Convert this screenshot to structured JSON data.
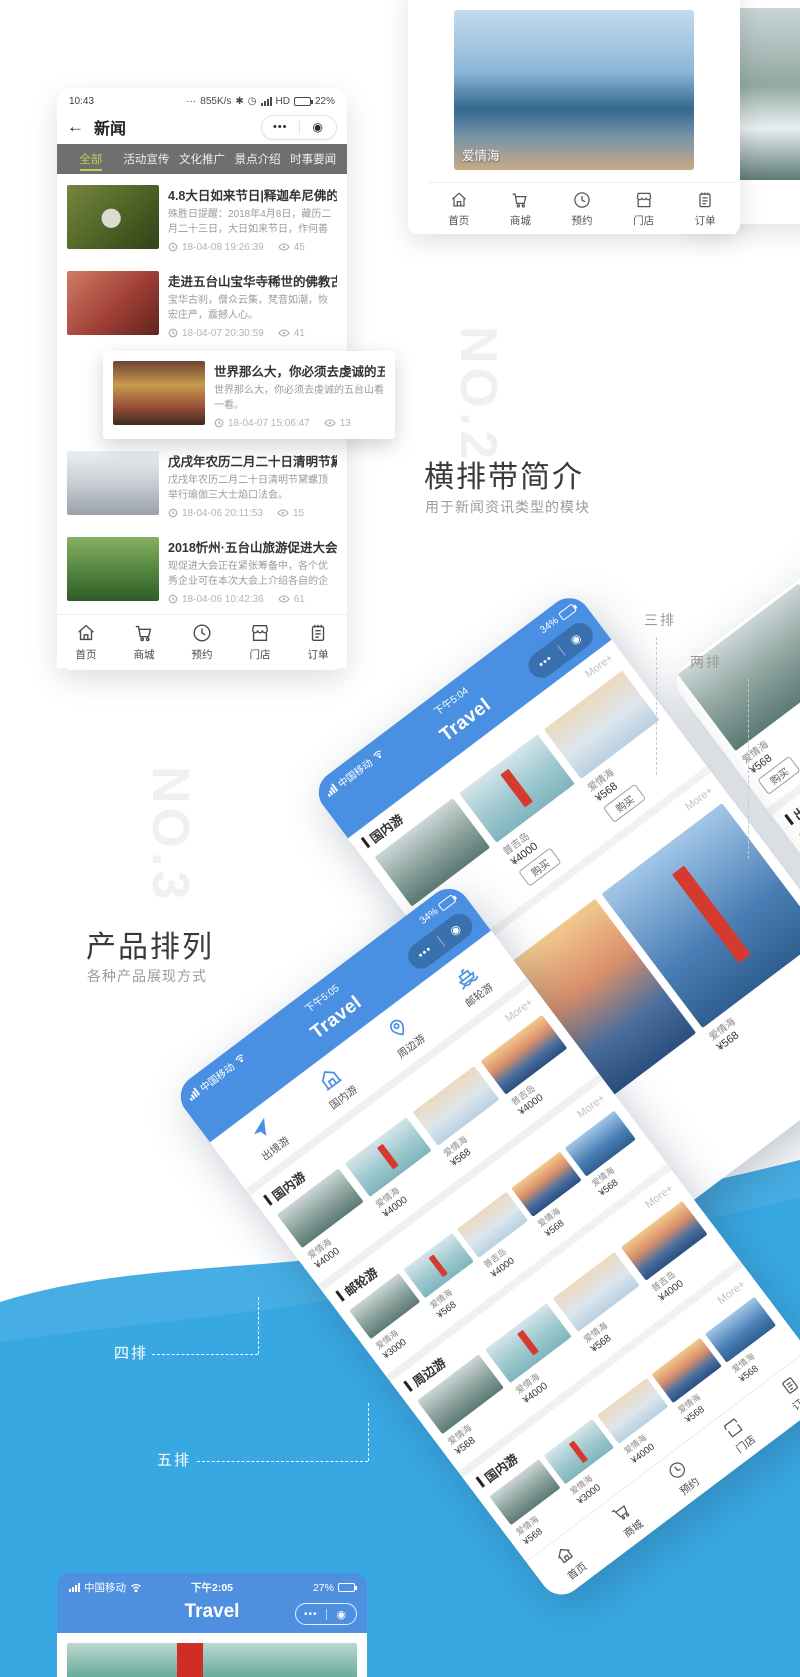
{
  "watermarks": {
    "no2": "NO.2",
    "no3": "NO.3"
  },
  "intro2": {
    "title": "横排带简介",
    "subtitle": "用于新闻资讯类型的模块"
  },
  "intro3": {
    "title": "产品排列",
    "subtitle": "各种产品展现方式"
  },
  "callouts": {
    "three": "三排",
    "two": "两排",
    "four": "四排",
    "five": "五排"
  },
  "tabbar": [
    "首页",
    "商城",
    "预约",
    "门店",
    "订单"
  ],
  "news_phone": {
    "status": {
      "time": "10:43",
      "dots": "···",
      "net": "855K/s",
      "bt": "✱",
      "alarm": "◷",
      "hd": "HD",
      "battery": "22%"
    },
    "navbar": {
      "back": "←",
      "title": "新闻",
      "menu": "•••",
      "capsule_target": "◉"
    },
    "tabs": [
      "全部",
      "活动宣传",
      "文化推广",
      "景点介绍",
      "时事要闻"
    ],
    "items": [
      {
        "title": "4.8大日如来节日|释迦牟尼佛的清净报",
        "desc": "殊胜日提醒：2018年4月8日，藏历二月二十三日，大日如来节日，作何善恶成亿倍!",
        "time": "18-04-08 19:26:39",
        "views": "45"
      },
      {
        "title": "走进五台山宝华寺稀世的佛教古建筑",
        "desc": "宝华古刹，僧众云集，梵音如潮，恢宏庄严，震撼人心。",
        "time": "18-04-07 20:30:59",
        "views": "41"
      },
      {
        "title": "世界那么大，你必须去虔诚的五台山看",
        "desc": "世界那么大，你必须去虔诚的五台山看一看。",
        "time": "18-04-07 15:06:47",
        "views": "13"
      },
      {
        "title": "戊戌年农历二月二十日清明节黛螺顶举",
        "desc": "戊戌年农历二月二十日清明节黛螺顶举行瑜伽三大士焰口法会。",
        "time": "18-04-06 20:11:53",
        "views": "15"
      },
      {
        "title": "2018忻州·五台山旅游促进大会即将召",
        "desc": "现促进大会正在紧张筹备中，各个优秀企业可在本次大会上介绍各自的企业文化等，大",
        "time": "18-04-06 10:42:36",
        "views": "61"
      }
    ]
  },
  "gallery_phone": {
    "card1_label": "爱情海",
    "card2_label": "爱情海"
  },
  "phone_a": {
    "carrier": "中国移动",
    "time": "下午5:04",
    "battery": "34%",
    "title": "Travel",
    "menu": "•••",
    "capsule_target": "◉",
    "section1": {
      "title": "国内游",
      "more": "More+",
      "items": [
        {
          "name": "爱情海",
          "price": "¥568",
          "buy": "购买"
        },
        {
          "name": "普吉岛",
          "price": "¥4000",
          "buy": "购买"
        },
        {
          "name": "爱情海",
          "price": "¥568",
          "buy": "购买"
        }
      ]
    },
    "section2": {
      "title": "出境游",
      "more": "More+",
      "items": [
        {
          "name": "爱情海",
          "price": "¥4000"
        },
        {
          "name": "爱情海",
          "price": "¥568"
        }
      ]
    }
  },
  "phone_b": {
    "row": {
      "items": [
        {
          "name": "爱情海",
          "price": "¥568",
          "buy": "购买"
        },
        {
          "name": "爱情海",
          "price": "¥4000",
          "buy": "购买"
        }
      ]
    },
    "section": {
      "title": "出境游",
      "more": "More+",
      "items": [
        {
          "name": "爱情海",
          "price": "¥4000"
        }
      ]
    }
  },
  "phone_c": {
    "carrier": "中国移动",
    "time": "下午5:05",
    "battery": "34%",
    "title": "Travel",
    "menu": "•••",
    "capsule_target": "◉",
    "categories": [
      "出境游",
      "国内游",
      "周边游",
      "邮轮游"
    ],
    "section1": {
      "title": "国内游",
      "more": "More+",
      "items": [
        {
          "name": "爱情海",
          "price": "¥4000"
        },
        {
          "name": "爱情海",
          "price": "¥4000"
        },
        {
          "name": "爱情海",
          "price": "¥568"
        },
        {
          "name": "普吉岛",
          "price": "¥4000"
        }
      ]
    },
    "section2": {
      "title": "邮轮游",
      "more": "More+",
      "items": [
        {
          "name": "爱情海",
          "price": "¥3000"
        },
        {
          "name": "爱情海",
          "price": "¥568"
        },
        {
          "name": "普吉岛",
          "price": "¥4000"
        },
        {
          "name": "爱情海",
          "price": "¥568"
        },
        {
          "name": "爱情海",
          "price": "¥568"
        }
      ]
    },
    "section3": {
      "title": "周边游",
      "more": "More+",
      "items": [
        {
          "name": "爱情海",
          "price": "¥568"
        },
        {
          "name": "爱情海",
          "price": "¥4000"
        },
        {
          "name": "爱情海",
          "price": "¥568"
        },
        {
          "name": "普吉岛",
          "price": "¥4000"
        }
      ]
    },
    "section4": {
      "title": "国内游",
      "more": "More+",
      "items": [
        {
          "name": "爱情海",
          "price": "¥568"
        },
        {
          "name": "爱情海",
          "price": "¥3000"
        },
        {
          "name": "爱情海",
          "price": "¥4000"
        },
        {
          "name": "爱情海",
          "price": "¥568"
        },
        {
          "name": "爱情海",
          "price": "¥568"
        }
      ]
    }
  },
  "bottom_phone": {
    "carrier": "中国移动",
    "time": "下午2:05",
    "battery": "27%",
    "title": "Travel",
    "menu": "•••",
    "capsule_target": "◉"
  }
}
